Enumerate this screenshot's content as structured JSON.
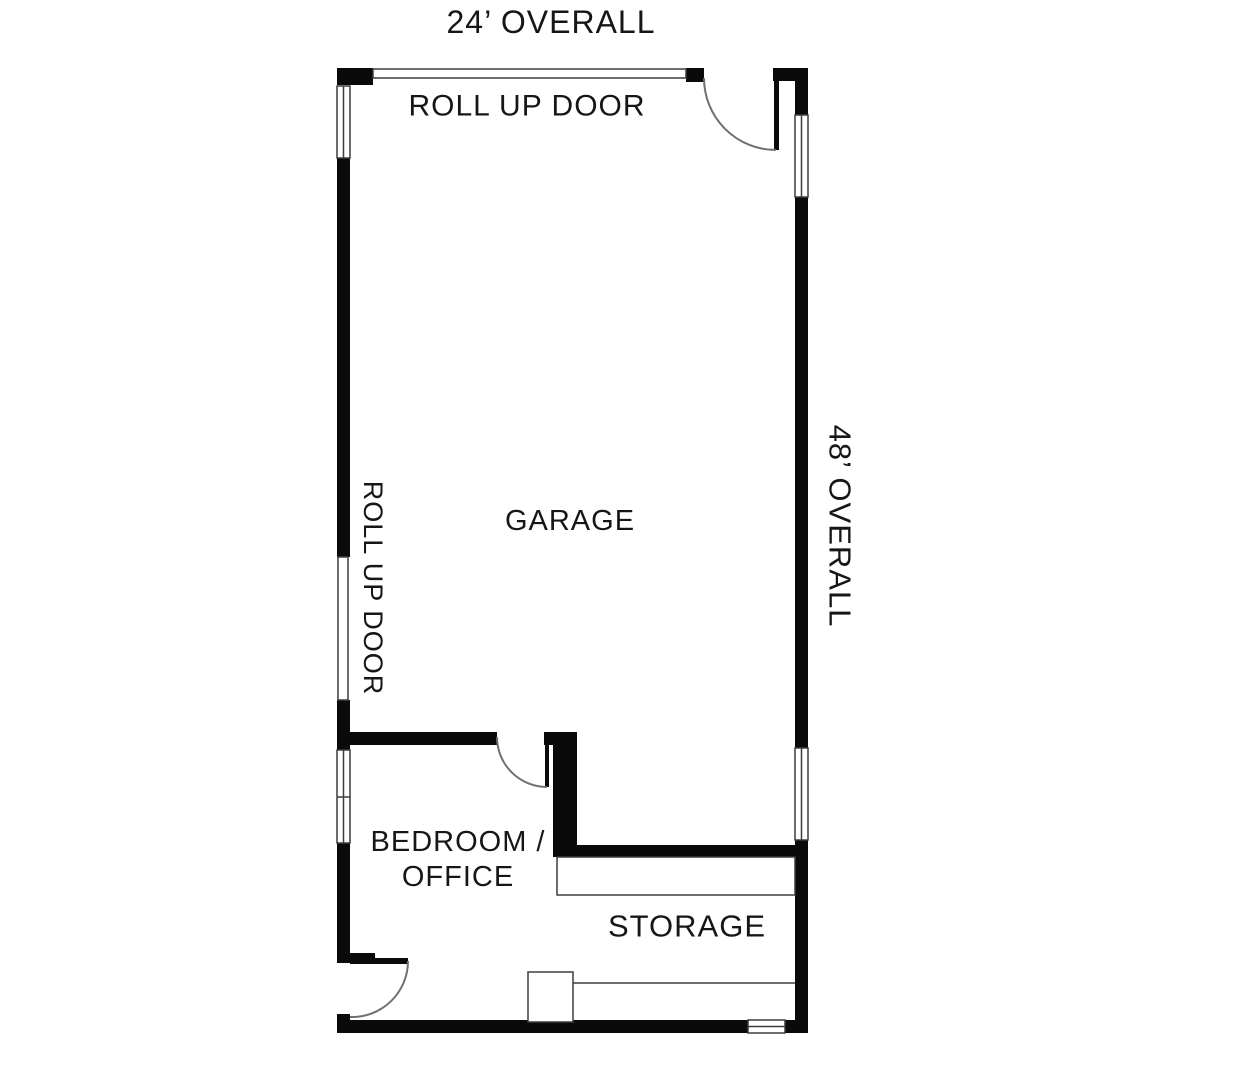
{
  "floor_plan": {
    "overall_width": "24’ OVERALL",
    "overall_height": "48’ OVERALL",
    "top_door_label": "ROLL UP DOOR",
    "left_door_label": "ROLL UP DOOR",
    "rooms": {
      "garage": "GARAGE",
      "bedroom_office_line1": "BEDROOM /",
      "bedroom_office_line2": "OFFICE",
      "storage": "STORAGE"
    },
    "colors": {
      "wall": "#0a0a0a",
      "thin_line": "#3d3d3d",
      "arc": "#707070",
      "text": "#161616",
      "background": "#ffffff"
    }
  }
}
